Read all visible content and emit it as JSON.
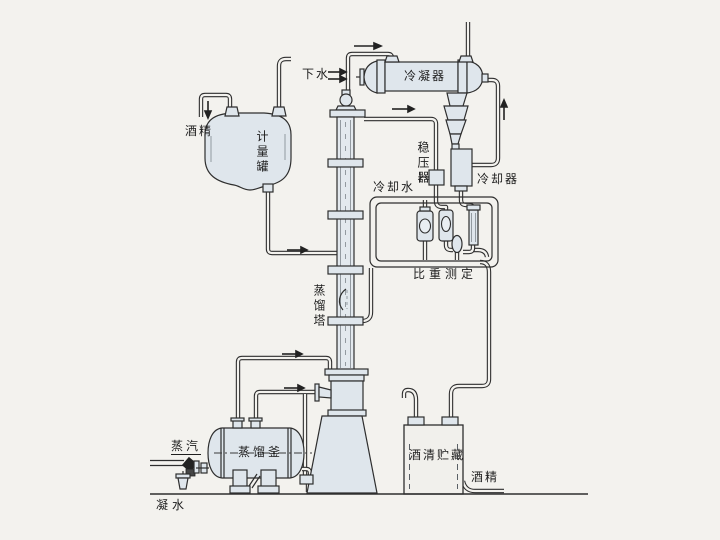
{
  "diagram_type": "distillation-process-flow-diagram",
  "colors": {
    "background": "#f3f2ee",
    "line": "#2e2e2e",
    "vessel_fill": "#dfe6ec"
  },
  "labels": {
    "drain_water": "下水",
    "condenser": "冷凝器",
    "alcohol_feed": "酒精",
    "measuring_tank": "计量罐",
    "pressure_stabilizer": "稳压器",
    "cooling_water": "冷却水",
    "cooler": "冷却器",
    "specific_gravity_measurement": "比重测定",
    "distillation_tower": "蒸馏塔",
    "distillation_kettle": "蒸馏釜",
    "steam": "蒸汽",
    "alcohol_storage": "酒清贮藏",
    "alcohol_outlet": "酒精",
    "condensate": "凝水"
  }
}
